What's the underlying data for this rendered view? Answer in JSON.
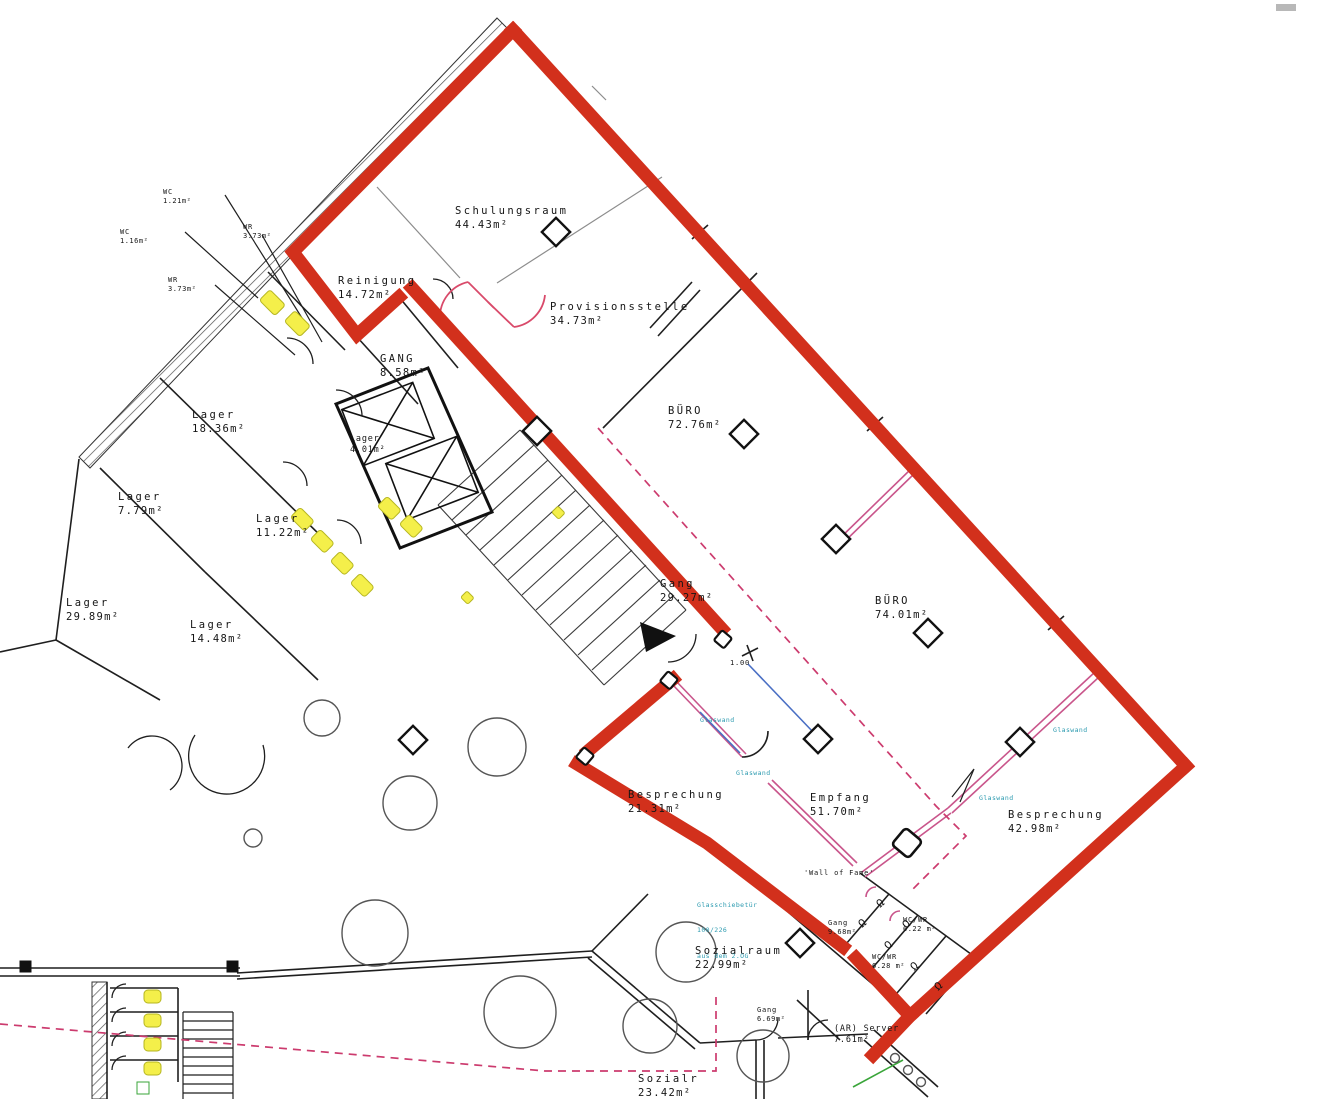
{
  "plan": {
    "type": "floor-plan",
    "language": "de",
    "colors": {
      "highlight_outline": "#d2301c",
      "walls": "#1f1f1f",
      "construction_gray": "#8c8c8c",
      "fixture_highlight": "#f4ef4a",
      "glass_partition_pink": "#c9558b",
      "dashed_partition": "#cc3b6e",
      "glass_wall_blue": "#4a6fc4",
      "annotation_cyan": "#2d9bb0",
      "green_mark": "#3aa53a"
    },
    "rooms": [
      {
        "name": "WC",
        "area": "1.21m²"
      },
      {
        "name": "WR",
        "area": "3.73m²"
      },
      {
        "name": "WC",
        "area": "1.16m²"
      },
      {
        "name": "WR",
        "area": "3.73m²"
      },
      {
        "name": "Reinigung",
        "area": "14.72m²"
      },
      {
        "name": "Schulungsraum",
        "area": "44.43m²"
      },
      {
        "name": "Provisionsstelle",
        "area": "34.73m²"
      },
      {
        "name": "GANG",
        "area": "8.58m²"
      },
      {
        "name": "BÜRO",
        "area": "72.76m²"
      },
      {
        "name": "Lager",
        "area": "18.36m²"
      },
      {
        "name": "Lager",
        "area": "4.01m²"
      },
      {
        "name": "Lager",
        "area": "7.79m²"
      },
      {
        "name": "Lager",
        "area": "11.22m²"
      },
      {
        "name": "Gang",
        "area": "29.27m²"
      },
      {
        "name": "BÜRO",
        "area": "74.01m²"
      },
      {
        "name": "Lager",
        "area": "29.89m²"
      },
      {
        "name": "Lager",
        "area": "14.48m²"
      },
      {
        "name": "Besprechung",
        "area": "21.31m²"
      },
      {
        "name": "Empfang",
        "area": "51.70m²"
      },
      {
        "name": "Besprechung",
        "area": "42.98m²"
      },
      {
        "name": "Sozialraum",
        "area": "22.99m²"
      },
      {
        "name": "WC/WR",
        "area": "6.22 m²"
      },
      {
        "name": "WC/WR",
        "area": "6.28 m²"
      },
      {
        "name": "(AR) Server",
        "area": "7.61m²"
      },
      {
        "name": "Sozialr",
        "area": "23.42m²"
      },
      {
        "name": "Teek.",
        "area": ""
      },
      {
        "name": "Gang",
        "area": "6.69m²"
      },
      {
        "name": "Gang",
        "area": "9.68m²"
      }
    ],
    "annotations": {
      "door_width": "1.00",
      "glass_wall": "Glaswand",
      "glass_door_line1": "Glasschiebetür",
      "glass_door_line2": "100/226",
      "glass_door_line3": "aus dem 2.OG",
      "wall_of_fame": "'Wall of Fame'"
    },
    "icons": {
      "stall_arc": "Ω"
    }
  }
}
